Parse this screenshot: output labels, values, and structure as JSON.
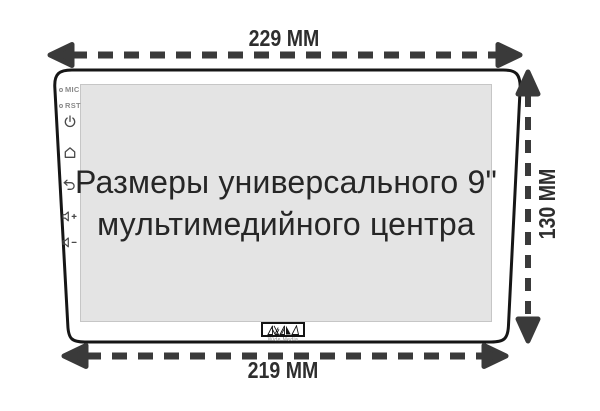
{
  "dimensions": {
    "top": {
      "label": "229 MM"
    },
    "bottom": {
      "label": "219 MM"
    },
    "right": {
      "label": "130 MM"
    }
  },
  "screen": {
    "title_line1": "Размеры универсального 9\"",
    "title_line2": "мультимедийного центра"
  },
  "side_panel": {
    "mic_label": "MIC",
    "rst_label": "RST",
    "icons": [
      "power-icon",
      "home-icon",
      "back-icon",
      "volume-up-icon",
      "volume-down-icon"
    ]
  },
  "logo": {
    "brand": "Wide Media"
  },
  "colors": {
    "outline": "#161616",
    "screen_fill": "#e4e4e4",
    "screen_border": "#c6c6c6",
    "arrow": "#3a3a3a",
    "dimension_text": "#2e2e2e",
    "side_text": "#8a8a8a",
    "icon_stroke": "#4a4a4a"
  }
}
